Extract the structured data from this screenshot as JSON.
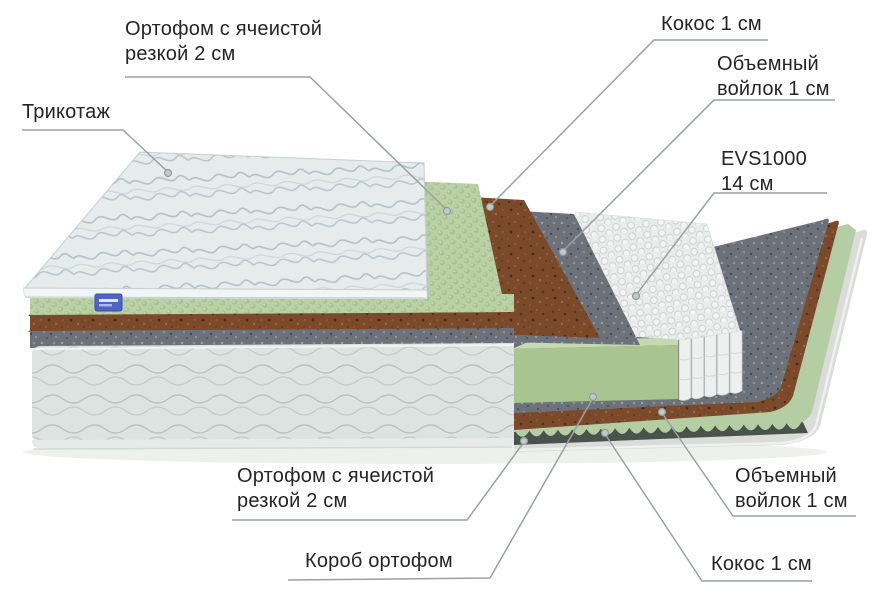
{
  "diagram": {
    "labels": {
      "tricot": {
        "line1": "Трикотаж"
      },
      "orthofoam_top": {
        "line1": "Ортофом с ячеистой",
        "line2": "резкой 2 см"
      },
      "coconut_top": {
        "line1": "Кокос 1 см"
      },
      "felt_top": {
        "line1": "Объемный",
        "line2": "войлок 1 см"
      },
      "springs": {
        "line1": "EVS1000",
        "line2": "14 см"
      },
      "orthofoam_bottom": {
        "line1": "Ортофом с ячеистой",
        "line2": "резкой 2 см"
      },
      "box": {
        "line1": "Короб ортофом"
      },
      "felt_bottom": {
        "line1": "Объемный",
        "line2": "войлок 1 см"
      },
      "coconut_bottom": {
        "line1": "Кокос 1 см"
      }
    },
    "colors": {
      "label_text": "#242624",
      "leader_line": "#9aa2a1",
      "foam_green": "#b6cfa2",
      "foam_green_block": "#a9c491",
      "coconut_brown": "#7b4b2b",
      "felt_gray": "#6b7076",
      "spring_white": "#edf0ee",
      "fabric_light": "#e6ebec",
      "box_quilt": "#dde3e0",
      "badge_blue": "#4e63c4"
    }
  }
}
